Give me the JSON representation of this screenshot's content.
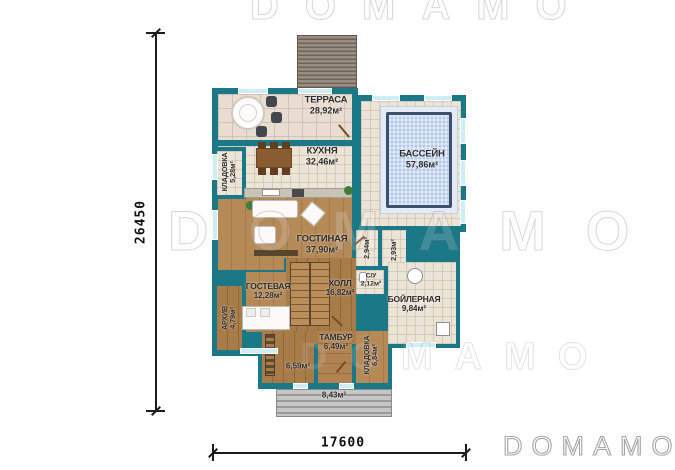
{
  "logo": {
    "text": "DOMAMO"
  },
  "watermark": {
    "text": "DOMAMO"
  },
  "dimensions": {
    "vertical": "26450",
    "horizontal": "17600"
  },
  "rooms": {
    "terrace": {
      "name": "ТЕРРАСА",
      "area": "28,92м²"
    },
    "kitchen": {
      "name": "КУХНЯ",
      "area": "32,46м²"
    },
    "pool": {
      "name": "БАССЕЙН",
      "area": "57,86м²"
    },
    "pantry_kitchen": {
      "name": "КЛАДОВКА",
      "area": "5,28м²"
    },
    "living": {
      "name": "ГОСТИНАЯ",
      "area": "37,90м²"
    },
    "guest": {
      "name": "ГОСТЕВАЯ",
      "area": "12,28м²"
    },
    "archive": {
      "name": "АРХИВ",
      "area": "4,79м²"
    },
    "hall": {
      "name": "ХОЛЛ",
      "area": "16,82м²"
    },
    "bathroom": {
      "name": "С/У",
      "area": "2,12м²"
    },
    "corridor_a": {
      "name": "",
      "area": "2,94м²"
    },
    "corridor_b": {
      "name": "",
      "area": "2,93м²"
    },
    "boiler": {
      "name": "БОЙЛЕРНАЯ",
      "area": "9,84м²"
    },
    "vestibule": {
      "name": "ТАМБУР",
      "area": "6,49м²"
    },
    "pantry_rear": {
      "name": "КЛАДОВКА",
      "area": "6,84м²"
    },
    "storage_small": {
      "name": "",
      "area": "6,59м²"
    },
    "porch": {
      "name": "",
      "area": "8,43м²"
    }
  },
  "colors": {
    "wall": "#1b7886",
    "tile": "#ece4d6",
    "terrace_tile": "#e9dcd0",
    "wood": "#b0854f",
    "pool_water": "#b0c7ea",
    "pool_border": "#3c4f6d",
    "window": "#cdeef5"
  }
}
